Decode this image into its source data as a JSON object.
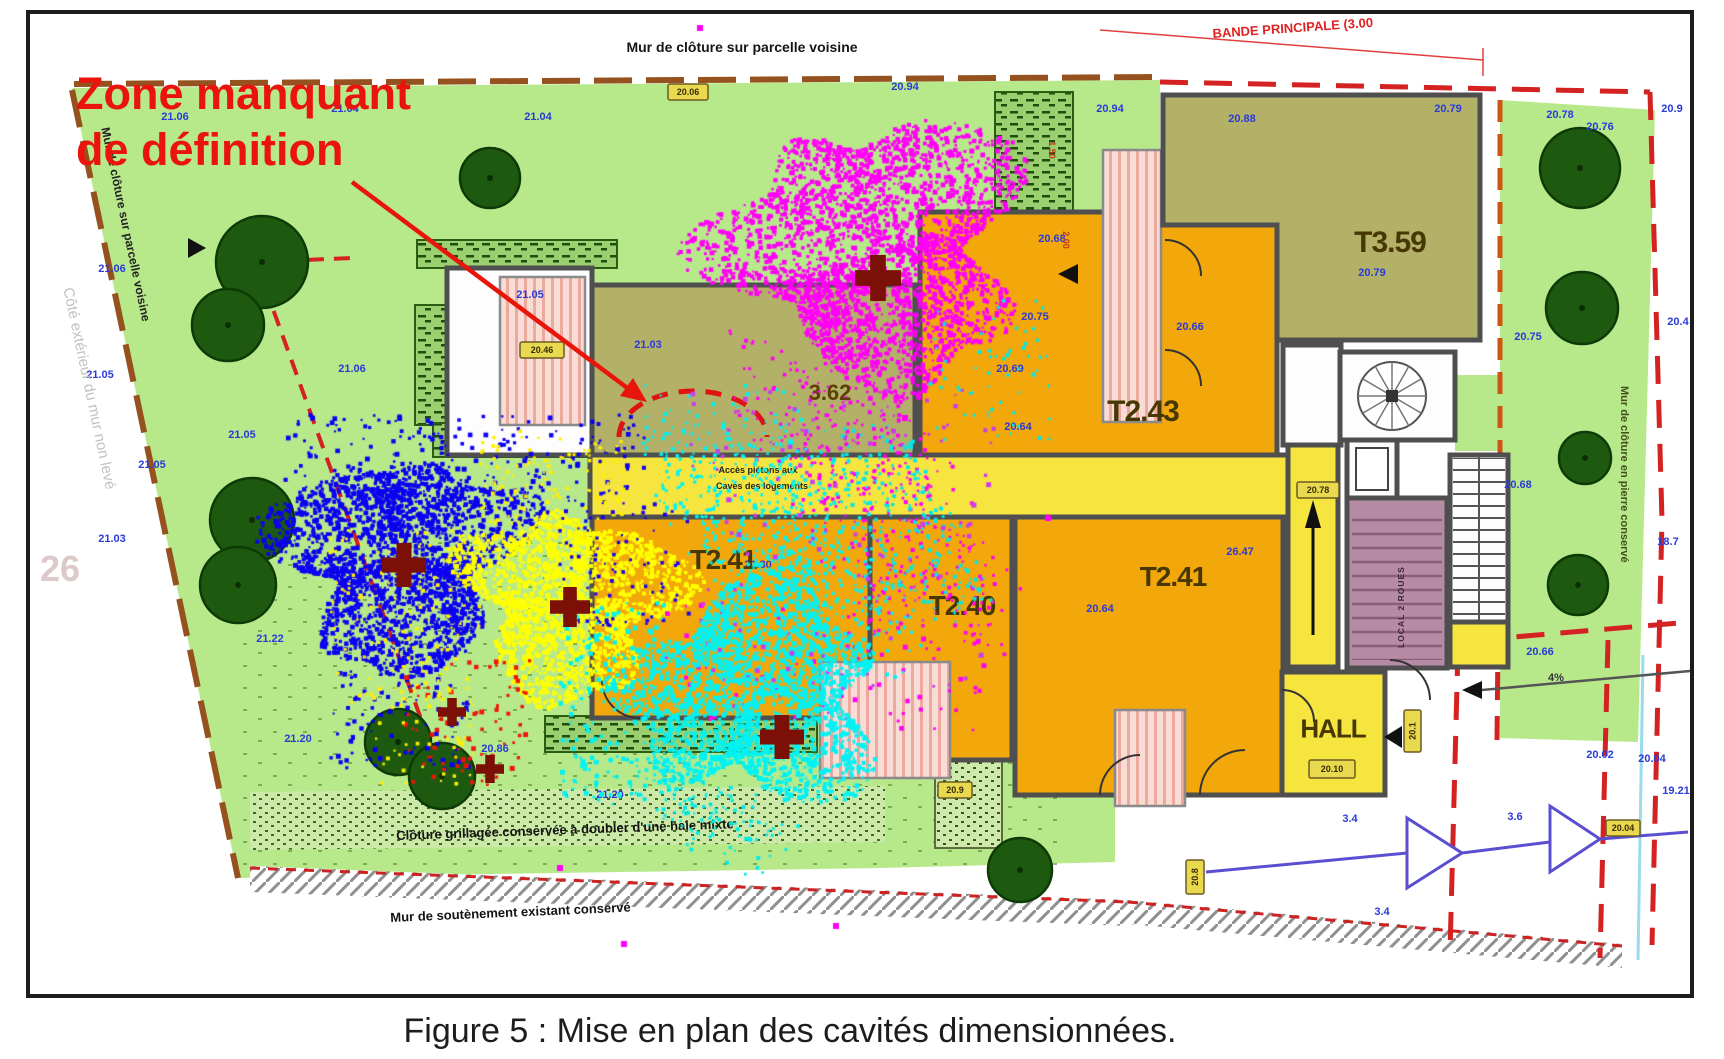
{
  "figure": {
    "caption": "Figure 5 : Mise en plan des cavités dimensionnées."
  },
  "annotations": {
    "zone_line1": "Zone manquant",
    "zone_line2": "de définition",
    "top_wall": "Mur de clôture sur parcelle voisine",
    "bande": "BANDE PRINCIPALE  (3.00",
    "left_wall": "Mur de clôture sur parcelle voisine",
    "left_outside": "Côté extérieur du mur non levé",
    "left_number": "26",
    "right_wall": "Mur de clôture en pierre conservé",
    "fence": "Clôture grillagée conservée à doubler d'une haie mixte",
    "retaining": "Mur de soutènement existant conservé",
    "corridor1": "Accès piétons aux",
    "corridor2": "Caves des logements",
    "slope": "4%",
    "local": "LOCAL 2 ROUES"
  },
  "rooms": {
    "t359": "T3.59",
    "t243": "T2.43",
    "t241l": "T2.41",
    "t240": "T2.40",
    "t241r": "T2.41",
    "hall": "HALL",
    "olive": "3.62"
  },
  "palette": {
    "garden": "#b7e98b",
    "tree": "#1d5a0f",
    "orange": "#f2a70a",
    "yellow": "#f5e53e",
    "olive": "#b3b067",
    "mauve": "#b68ba4",
    "wall": "#4f4f4f",
    "red": "#e01212",
    "dim_blue": "#2b3bd6",
    "cloud_magenta": "#ff00f6",
    "cloud_blue": "#0d00f2",
    "cloud_cyan": "#00f2f2",
    "cloud_yellow": "#ffff00",
    "cross": "#7c0f06"
  },
  "dimensions": [
    [
      175,
      120,
      "21.06"
    ],
    [
      345,
      112,
      "21.04"
    ],
    [
      538,
      120,
      "21.04"
    ],
    [
      694,
      98,
      "21.06"
    ],
    [
      905,
      90,
      "20.94"
    ],
    [
      1110,
      112,
      "20.94"
    ],
    [
      1242,
      122,
      "20.88"
    ],
    [
      1448,
      112,
      "20.79"
    ],
    [
      1600,
      130,
      "20.76"
    ],
    [
      112,
      272,
      "21.06"
    ],
    [
      100,
      378,
      "21.05"
    ],
    [
      152,
      468,
      "21.05"
    ],
    [
      112,
      542,
      "21.03"
    ],
    [
      242,
      438,
      "21.05"
    ],
    [
      352,
      372,
      "21.06"
    ],
    [
      530,
      298,
      "21.05"
    ],
    [
      648,
      348,
      "21.03"
    ],
    [
      270,
      642,
      "21.22"
    ],
    [
      298,
      742,
      "21.20"
    ],
    [
      610,
      798,
      "21.20"
    ],
    [
      495,
      752,
      "20.86"
    ],
    [
      1052,
      242,
      "20.68"
    ],
    [
      1035,
      320,
      "20.75"
    ],
    [
      1190,
      330,
      "20.66"
    ],
    [
      1010,
      372,
      "20.69"
    ],
    [
      1018,
      430,
      "20.64"
    ],
    [
      1372,
      276,
      "20.79"
    ],
    [
      758,
      568,
      "21.30"
    ],
    [
      1240,
      555,
      "26.47"
    ],
    [
      1100,
      612,
      "20.64"
    ],
    [
      1528,
      340,
      "20.75"
    ],
    [
      1518,
      488,
      "20.68"
    ],
    [
      1540,
      655,
      "20.66"
    ],
    [
      1560,
      118,
      "20.78"
    ],
    [
      1672,
      112,
      "20.9"
    ],
    [
      1678,
      325,
      "20.4"
    ],
    [
      1668,
      545,
      "18.7"
    ],
    [
      1600,
      758,
      "20.02"
    ],
    [
      1652,
      762,
      "20.04"
    ],
    [
      1676,
      794,
      "19.21"
    ],
    [
      1350,
      822,
      "3.4"
    ],
    [
      1515,
      820,
      "3.6"
    ],
    [
      1382,
      915,
      "3.4"
    ]
  ],
  "red_marks": [
    [
      1049,
      150,
      "1.50"
    ],
    [
      1063,
      240,
      "2.00"
    ]
  ],
  "badges": [
    [
      520,
      342,
      44,
      16,
      "20.46",
      0
    ],
    [
      668,
      84,
      40,
      16,
      "20.06",
      0
    ],
    [
      1297,
      482,
      42,
      16,
      "20.78",
      0
    ],
    [
      1309,
      760,
      46,
      18,
      "20.10",
      0
    ],
    [
      1404,
      710,
      17,
      42,
      "20.1",
      1
    ],
    [
      1606,
      820,
      34,
      16,
      "20.04",
      0
    ],
    [
      1186,
      860,
      18,
      34,
      "20.8",
      1
    ],
    [
      938,
      782,
      34,
      16,
      "20.9",
      0
    ]
  ],
  "trees": [
    [
      262,
      262,
      46
    ],
    [
      228,
      325,
      36
    ],
    [
      252,
      520,
      42
    ],
    [
      238,
      585,
      38
    ],
    [
      490,
      178,
      30
    ],
    [
      398,
      742,
      33
    ],
    [
      442,
      776,
      33
    ],
    [
      1020,
      870,
      32
    ],
    [
      1580,
      168,
      40
    ],
    [
      1582,
      308,
      36
    ],
    [
      1585,
      458,
      26
    ],
    [
      1578,
      585,
      30
    ]
  ],
  "clouds": [
    {
      "type": "blob",
      "cx": 400,
      "cy": 560,
      "rx": 112,
      "ry": 105,
      "n": 2500,
      "color": "#0d00f2",
      "seed": 11,
      "size": 4
    },
    {
      "type": "scatter",
      "x": 285,
      "y": 415,
      "w": 360,
      "h": 95,
      "n": 230,
      "color": "#0d00f2",
      "seed": 12,
      "size": 4
    },
    {
      "type": "scatter",
      "x": 330,
      "y": 640,
      "w": 140,
      "h": 130,
      "n": 120,
      "color": "#0d00f2",
      "seed": 13,
      "size": 4
    },
    {
      "type": "blob",
      "cx": 572,
      "cy": 602,
      "rx": 100,
      "ry": 92,
      "n": 2100,
      "color": "#ffff00",
      "seed": 21,
      "size": 4
    },
    {
      "type": "scatter",
      "x": 330,
      "y": 530,
      "w": 150,
      "h": 180,
      "n": 110,
      "color": "#ffee00",
      "seed": 22,
      "size": 3
    },
    {
      "type": "scatter",
      "x": 480,
      "y": 430,
      "w": 150,
      "h": 110,
      "n": 140,
      "color": "#ffee00",
      "seed": 23,
      "size": 3
    },
    {
      "type": "scatter",
      "x": 560,
      "y": 500,
      "w": 130,
      "h": 130,
      "n": 90,
      "color": "#1a00ee",
      "seed": 24,
      "size": 3
    },
    {
      "type": "blob",
      "cx": 876,
      "cy": 250,
      "rx": 142,
      "ry": 130,
      "n": 3000,
      "color": "#ff00f6",
      "seed": 31,
      "size": 4
    },
    {
      "type": "spray",
      "x0": 800,
      "y0": 370,
      "x1": 950,
      "y1": 620,
      "w": 150,
      "n": 420,
      "color": "#ff00f6",
      "seed": 32,
      "size": 3
    },
    {
      "type": "scatter",
      "x": 660,
      "y": 600,
      "w": 330,
      "h": 130,
      "n": 90,
      "color": "#ff00f6",
      "seed": 33,
      "size": 4
    },
    {
      "type": "scatter",
      "x": 930,
      "y": 300,
      "w": 120,
      "h": 140,
      "n": 60,
      "color": "#00e8e8",
      "seed": 46,
      "size": 3
    },
    {
      "type": "blob",
      "cx": 755,
      "cy": 690,
      "rx": 120,
      "ry": 110,
      "n": 2400,
      "color": "#00f2f2",
      "seed": 41,
      "size": 4
    },
    {
      "type": "spray",
      "x0": 710,
      "y0": 430,
      "x1": 850,
      "y1": 640,
      "w": 160,
      "n": 650,
      "color": "#00f2f2",
      "seed": 42,
      "size": 3
    },
    {
      "type": "spray",
      "x0": 860,
      "y0": 440,
      "x1": 950,
      "y1": 600,
      "w": 90,
      "n": 220,
      "color": "#00e8e8",
      "seed": 43,
      "size": 3
    },
    {
      "type": "scatter",
      "x": 560,
      "y": 600,
      "w": 110,
      "h": 200,
      "n": 170,
      "color": "#00f2f2",
      "seed": 44,
      "size": 4
    },
    {
      "type": "spray",
      "x0": 640,
      "y0": 770,
      "x1": 760,
      "y1": 850,
      "w": 90,
      "n": 140,
      "color": "#00eaea",
      "seed": 45,
      "size": 3
    },
    {
      "type": "scatter",
      "x": 690,
      "y": 390,
      "w": 310,
      "h": 300,
      "n": 130,
      "color": "#cc3bee",
      "seed": 51,
      "size": 4
    },
    {
      "type": "scatter",
      "x": 405,
      "y": 660,
      "w": 125,
      "h": 125,
      "n": 80,
      "color": "#ee1606",
      "seed": 61,
      "size": 4
    },
    {
      "type": "scatter",
      "x": 375,
      "y": 680,
      "w": 100,
      "h": 105,
      "n": 55,
      "color": "#ffee00",
      "seed": 62,
      "size": 3
    }
  ],
  "dots": [
    [
      700,
      28
    ],
    [
      836,
      926
    ],
    [
      624,
      944
    ],
    [
      1048,
      518
    ],
    [
      560,
      868
    ],
    [
      905,
      418
    ]
  ],
  "crosses": [
    [
      878,
      278,
      46
    ],
    [
      404,
      565,
      44
    ],
    [
      570,
      607,
      40
    ],
    [
      782,
      737,
      44
    ],
    [
      452,
      712,
      28
    ],
    [
      490,
      769,
      28
    ]
  ]
}
